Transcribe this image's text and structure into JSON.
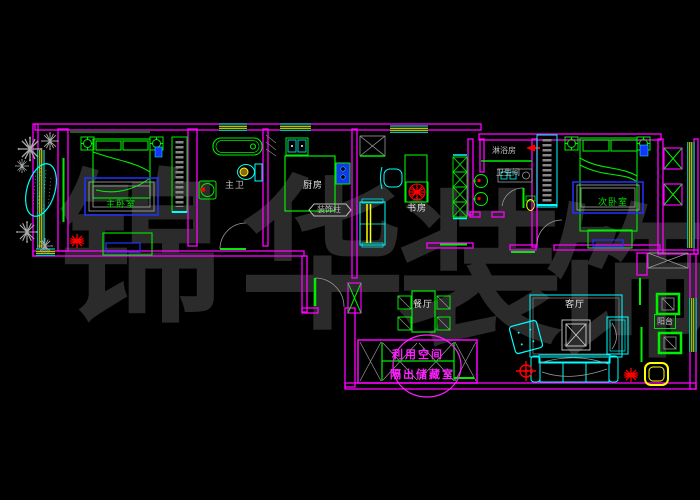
{
  "colors": {
    "background": "#000000",
    "wall": "#ff00ff",
    "fixture_green": "#00ee00",
    "furniture_cyan": "#00ffff",
    "window_yellow": "#ffff00",
    "rug_blue": "#2233ff",
    "alert_red": "#ff0000",
    "drawing_gray": "#999999",
    "label_white": "#e8e8e8",
    "watermark_gray": "#2b2b2b"
  },
  "watermark": {
    "char1": "锦",
    "char2": "华",
    "char3": "装",
    "char4": "饰"
  },
  "rooms": {
    "master_bedroom": {
      "label": "主卧室"
    },
    "master_bath": {
      "label": "主卫"
    },
    "kitchen": {
      "label": "厨房"
    },
    "study": {
      "label": "书房"
    },
    "shower_room": {
      "label": "淋浴房"
    },
    "bathroom": {
      "label": "卫生间"
    },
    "bedroom2": {
      "label": "次卧室"
    },
    "dining": {
      "label": "餐厅"
    },
    "living": {
      "label": "客厅"
    },
    "balcony": {
      "label": "阳台"
    }
  },
  "labels": {
    "decor_column": "装饰柱"
  },
  "annotation": {
    "line1": "利用空间",
    "line2": "隔出储藏室"
  }
}
